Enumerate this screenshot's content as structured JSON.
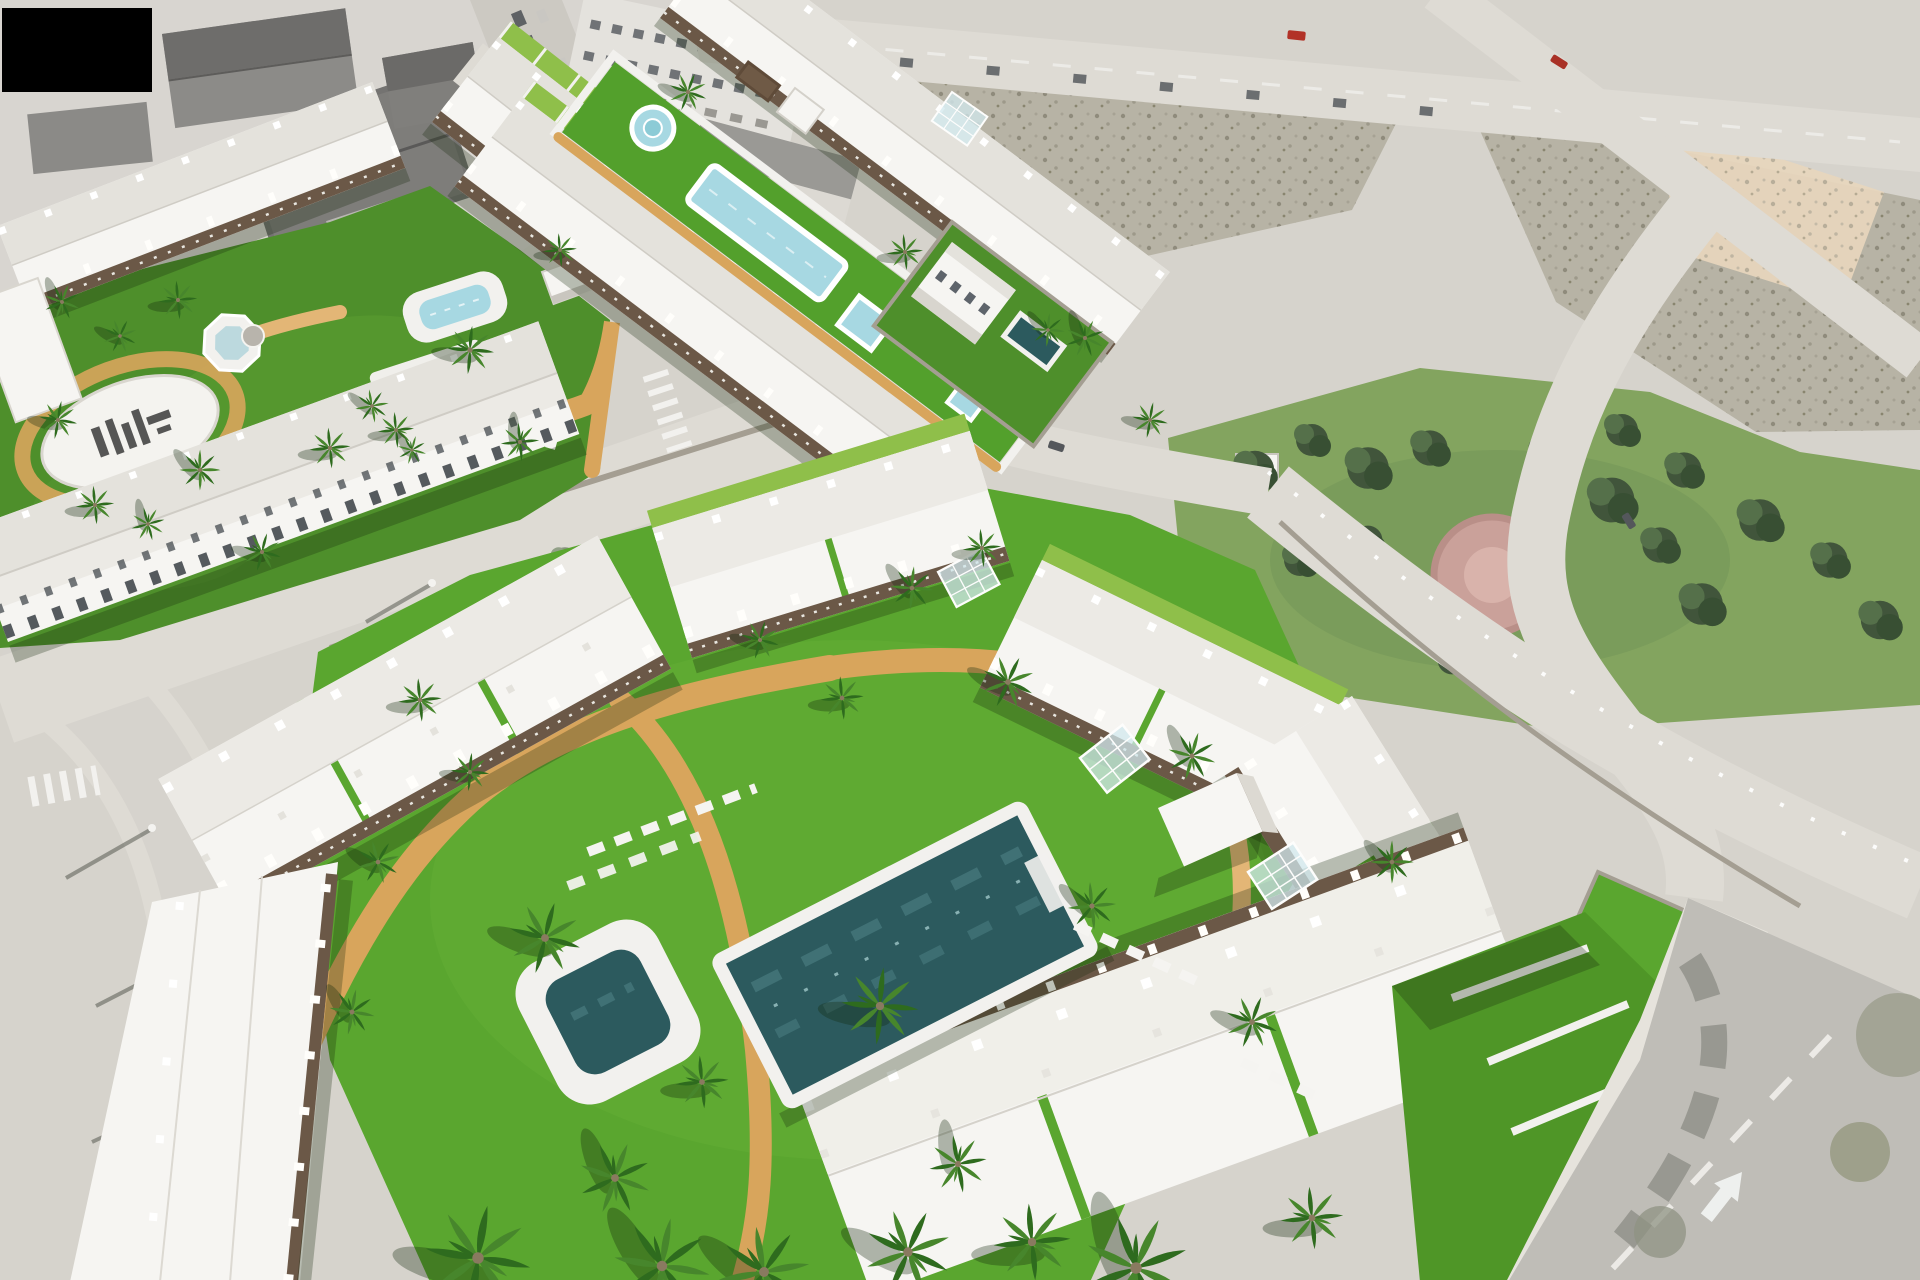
{
  "meta": {
    "title": "Aerial 3D render of a new-build residential development",
    "description": "Computer-generated aerial view of a coastal residential development: white townhouse and apartment blocks arranged around communal lawns with swimming pools, palm trees and sand-coloured paths; bordered by an existing grey town block, empty scrubland plots, a tree-filled public park and perimeter roads with crossings and a lane arrow.",
    "width_px": 1920,
    "height_px": 1280
  },
  "palette": {
    "pavement": "#d6d3cc",
    "roadLight": "#dedbd4",
    "roadMid": "#cdcac3",
    "asphalt": "#bfbdb7",
    "sidewalk": "#e6e3dc",
    "white": "#f6f5f2",
    "offWhite": "#eceae5",
    "roofShade": "#e4e2dc",
    "pergola": "#6b5847",
    "wood": "#5f4b39",
    "grass": "#5aa62f",
    "grassA": "#4e8f2b",
    "grassDark": "#3a7418",
    "grassBright": "#8fbf4a",
    "path": "#d8a55c",
    "pathLight": "#e3b676",
    "poolDark": "#2c5a5e",
    "poolMid": "#47797d",
    "poolLight": "#a7d8e2",
    "deck": "#f2f1ee",
    "scrub": "#b7b3a5",
    "scrubDot": "#8f8b7c",
    "sand": "#e7d6bd",
    "treeDark": "#41553b",
    "treeMid": "#55704a",
    "wallStone": "#a49e92",
    "shadow": "rgba(22,40,12,0.28)",
    "trunk": "#8a7a60",
    "palmDark": "#2e6b1e",
    "palmMid": "#47862c",
    "carDark": "#54575b",
    "carRed": "#b23227",
    "playPink": "#caa19a",
    "glass": "rgba(210,232,238,0.75)",
    "parkGrass": "#83a45f",
    "logoInk": "#3b3b3b"
  },
  "regions": [
    {
      "id": "existing-town",
      "label": "Existing town blocks with parked cars (top left)"
    },
    {
      "id": "top-road",
      "label": "Boundary road with passing traffic along the top edge"
    },
    {
      "id": "vacant-plots",
      "label": "Undeveloped scrubland plots with a sandy patch (top right)"
    },
    {
      "id": "public-park",
      "label": "Public park with mature trees and a circular playground (right)"
    },
    {
      "id": "phase-a-complex",
      "label": "Garden community with two pools, octagonal fountain and oval ground emblem (upper left)"
    },
    {
      "id": "linear-garden-complex",
      "label": "Townhouse rows flanking a linear communal garden with lap pool and round fountain (upper middle)"
    },
    {
      "id": "detached-villa",
      "label": "Detached two-storey villa with private pool (centre right)"
    },
    {
      "id": "main-complex",
      "label": "Foreground apartment complex around a large communal lawn (bottom)"
    },
    {
      "id": "main-pool-area",
      "label": "Large communal swimming pool with white deck, plunge pool, pavilion and sun loungers"
    },
    {
      "id": "internal-streets",
      "label": "Internal streets with stone walls, zebra crossings and street lamps"
    },
    {
      "id": "right-road",
      "label": "Asphalt road with lane arrow and overhanging trees (bottom right)"
    }
  ],
  "features": {
    "pools": [
      "main communal pool (dark water, white deck)",
      "square plunge pool with rounded deck",
      "family pool with rounded white deck (phase A)",
      "dark garden pool with palm corner (phase A)",
      "octagonal fountain",
      "linear lap pool",
      "round fountain",
      "small square pool",
      "villa private pool"
    ],
    "landscape": [
      "vivid communal lawns",
      "sand-coloured curving walking paths",
      "palm trees of varied sizes",
      "park trees",
      "white sun loungers",
      "white garden pavilion cube",
      "tilted glass pergolas",
      "oval ground emblem with dark marks"
    ],
    "traffic": [
      "zebra crossings",
      "white lane arrow",
      "rows of parked cars",
      "two red cars on boundary roads",
      "street lamps with long shadows"
    ]
  }
}
